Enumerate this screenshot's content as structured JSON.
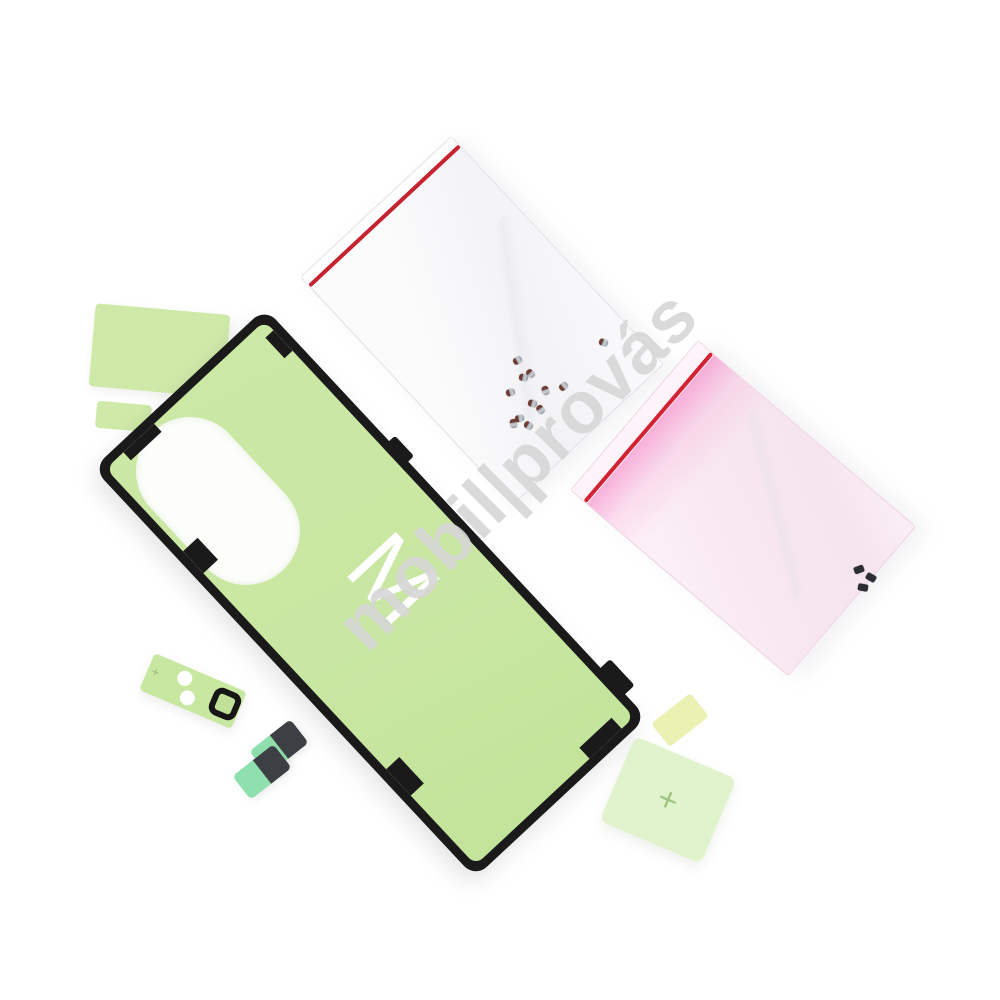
{
  "photo": {
    "type": "product-photo",
    "background": "#ffffff"
  },
  "watermark": {
    "text": "mobil|provás",
    "color": "#d6d6d6"
  },
  "sheet": {
    "letter": "M",
    "green": "#c9e7a2",
    "outline": "#1a1a1a",
    "cutout": "#ffffff"
  },
  "tabs": {
    "plus_mark": "+",
    "green": "#cfeaa8",
    "plus_tab_green": "#def1c4",
    "mini_tab_yellow": "#ebf1b2"
  },
  "camera_strip": {
    "plus_mark": "+",
    "green": "#c8e7a0",
    "ring": "#161616",
    "holes": "#ffffff"
  },
  "stickers": {
    "count": 2,
    "mint": "#8fe0ae",
    "dark": "#3c4045"
  },
  "bags": {
    "clear": {
      "body": "#fafafc",
      "zip": "#c52330",
      "screw_count": 12,
      "screw_silver": "#a9aeb6",
      "screw_brown": "#6f3d34"
    },
    "pink": {
      "body": "#f8e9f1",
      "zip": "#d22233",
      "streak": "#f6b2d8",
      "screw_count": 3,
      "screw_dark": "#2b2e33"
    }
  }
}
